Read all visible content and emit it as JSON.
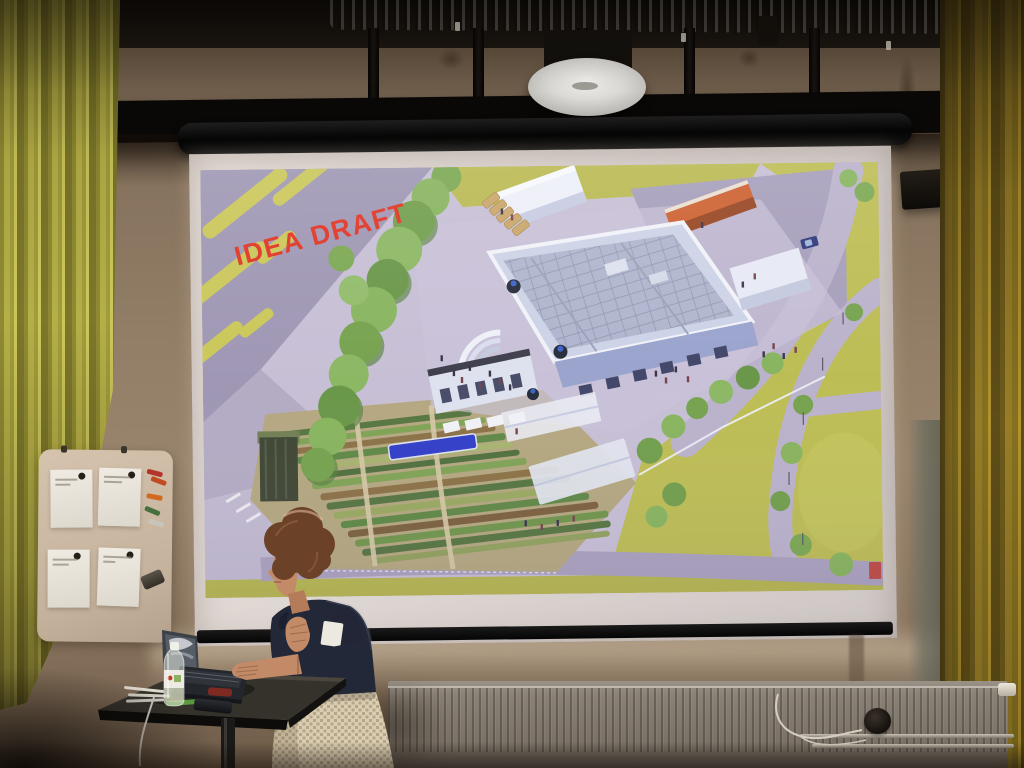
{
  "scene": {
    "setting": "presentation room photograph",
    "description": "A presenter stands at a tall laptop table in front of a wall projection screen showing an aerial architectural site-plan rendering marked as a draft."
  },
  "projection": {
    "watermark_text": "IDEA DRAFT",
    "watermark_color": "#e0301e",
    "slide_type": "isometric site plan rendering with buildings, gardens, roads and trees"
  },
  "objects": {
    "wifi_access_point": "round ceiling access point",
    "ventilation_duct": "spiral metal duct",
    "wall_speaker": "black wall speaker",
    "whiteboard_note_count": 4,
    "marker_count": 5,
    "laptop": "open laptop",
    "water_bottle": "clear plastic bottle",
    "phone": "smartphone",
    "radiator": "panel radiator",
    "presenter": "woman with curly hair, dark top, patterned skirt"
  },
  "palette": {
    "curtain_left": "#a9a23e",
    "curtain_right": "#8a7420",
    "wall": "#937e67",
    "ceiling": "#17120d",
    "screen_casing": "#0c0c0c",
    "screen_surface": "#dcd4d0",
    "slide_background": "#c6bed4",
    "slide_grass": "#bcbc52",
    "slide_road": "#a79fba",
    "slide_tree": "#7fa855",
    "slide_building": "#dfe3f2",
    "slide_accent_building": "#cc5e2d",
    "table": "#191714",
    "radiator": "#847b6f",
    "presenter_top": "#232838",
    "presenter_skirt": "#d9cdb3",
    "presenter_hair": "#6b4227"
  }
}
